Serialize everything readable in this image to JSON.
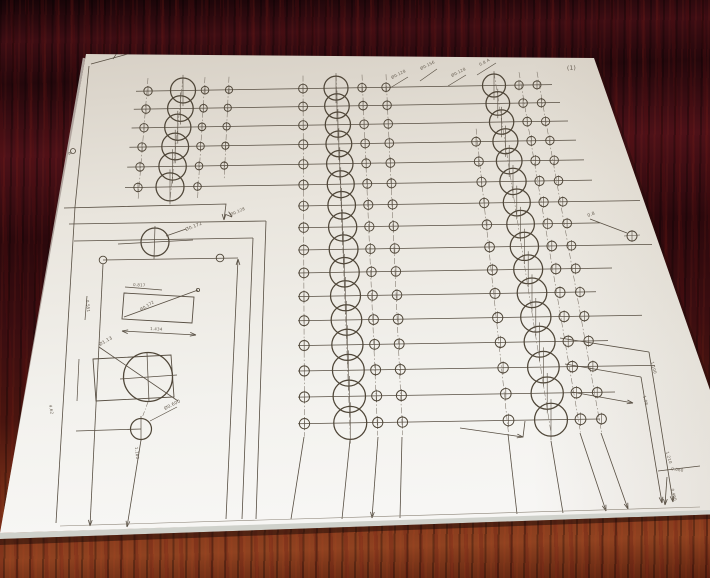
{
  "colors": {
    "wood_dark": "#2c0a0d",
    "wood_mid": "#4d1216",
    "wood_bottom_light": "#8a3d1e",
    "paper_top": "#d7d0c5",
    "paper_bottom": "#f6f5f2",
    "ink": "#574e42"
  },
  "paper": {
    "page_mark": "(1)",
    "edge_mark": "B",
    "callouts": {
      "c1": "Ø0.128",
      "c2": "Ø0.156",
      "c3": "Ø0.128",
      "c4": "0.8 A",
      "c5": "0.8",
      "c6": "Ø0.128"
    },
    "dims": {
      "circle1": "Ø0.172",
      "rect1_top": "0.817",
      "rect1_diag": "Ø0.172",
      "rect1_bottom": "1.434",
      "rect1_left": "0.551",
      "rect2_diag": "Ø1.13",
      "circle3": "Ø0.600",
      "v_bottom_left": "1.180",
      "v_left": "4.62",
      "r1": "1.100",
      "r2": "1.08",
      "r3": "1.210",
      "r4": "0.060",
      "r5": "0.400"
    }
  }
}
